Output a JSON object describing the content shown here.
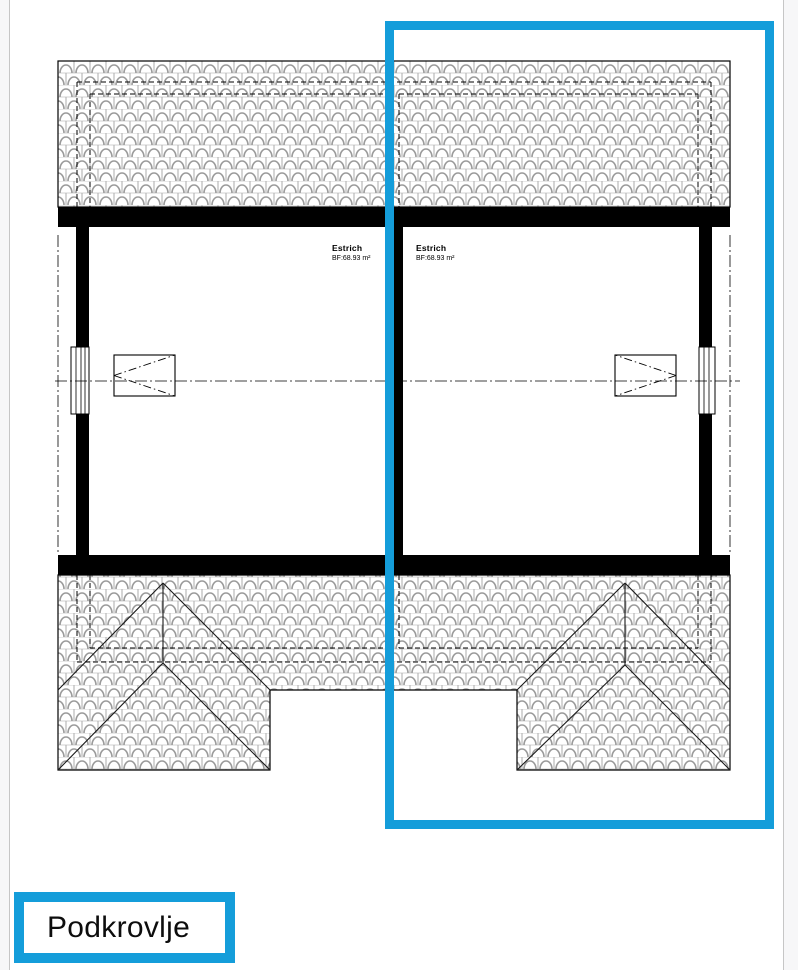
{
  "page": {
    "background_color": "#f7f7f8",
    "surface_color": "#ffffff",
    "accent_color": "#149dda"
  },
  "plan": {
    "rooms": [
      {
        "name": "Estrich",
        "area": "BF:68.93 m²"
      },
      {
        "name": "Estrich",
        "area": "BF:68.93 m²"
      }
    ]
  },
  "selection": {
    "color": "#149dda"
  },
  "floor_label": {
    "text": "Podkrovlje",
    "border_color": "#149dda"
  }
}
